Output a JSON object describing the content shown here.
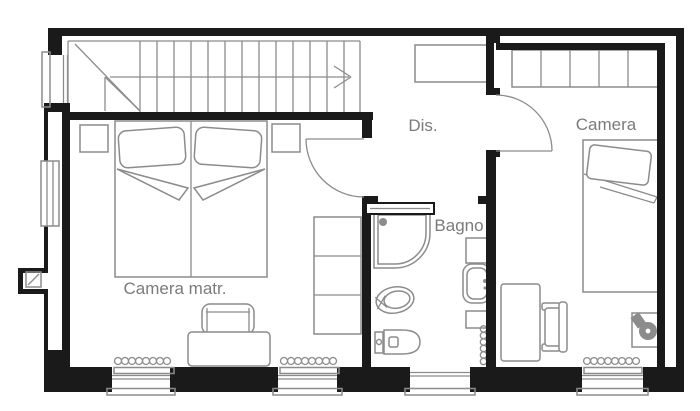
{
  "plan": {
    "type": "floor-plan",
    "background": "#ffffff",
    "wall_color": "#1a1a1a",
    "furniture_color": "#8c8c8c",
    "label_color": "#7b7b7b",
    "rooms": [
      {
        "label": "Dis."
      },
      {
        "label": "Camera"
      },
      {
        "label": "Bagno"
      },
      {
        "label": "Camera matr."
      }
    ],
    "fixtures": [
      "staircase-with-up-arrow",
      "double-bed",
      "nightstand",
      "armchair",
      "built-in-wardrobe",
      "single-bed",
      "desk",
      "desk-chair",
      "corner-table-with-lamp",
      "shower",
      "bidet",
      "toilet",
      "washbasin",
      "radiator",
      "window",
      "sliding-door",
      "hinged-door",
      "flue"
    ]
  }
}
